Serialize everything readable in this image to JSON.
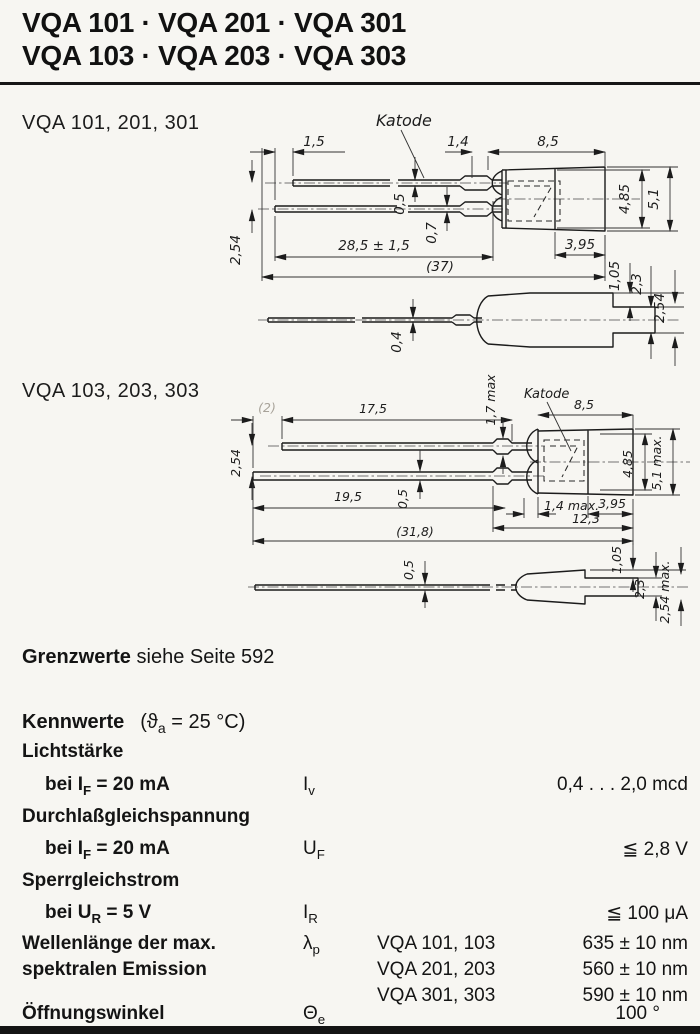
{
  "header": {
    "title_line1": "VQA 101 · VQA 201 · VQA 301",
    "title_line2": "VQA 103 · VQA 203 · VQA 303"
  },
  "sections": {
    "drawing1_label": "VQA 101, 201, 301",
    "drawing2_label": "VQA 103, 203, 303"
  },
  "drawing1": {
    "dims": {
      "lead_offset": "1,5",
      "katode": "Katode",
      "gap": "1,4",
      "body_len": "8,5",
      "lead_upper_th": "0,5",
      "lead_lower_th": "0,7",
      "lead_len": "28,5 ± 1,5",
      "overall": "(37)",
      "lead_pitch": "2,54",
      "body_inner_h": "4,85",
      "body_outer_h": "5,1",
      "body_back": "3,95",
      "side_lead_th": "0,4",
      "side_step": "1,05",
      "side_nose": "2,3",
      "side_nose_max": "2,54"
    }
  },
  "drawing2": {
    "dims": {
      "lead_offset": "(2)",
      "lead_upper_len": "17,5",
      "crimp_max": "1,7 max",
      "katode": "Katode",
      "body_len": "8,5",
      "lead_pitch": "2,54",
      "lead_lower_th": "0,5",
      "lead_lower_len": "19,5",
      "dome_max": "1,4 max.",
      "body_back": "3,95",
      "body_total": "12,3",
      "overall": "(31,8)",
      "body_inner_h": "4,85",
      "body_outer_h": "5,1 max.",
      "side_lead_th": "0,5",
      "side_step": "1,05",
      "side_nose": "2,3",
      "side_nose_max": "2,54 max."
    }
  },
  "grenzwerte": {
    "label_bold": "Grenzwerte",
    "label_rest": "siehe Seite 592"
  },
  "kennwerte": {
    "heading": "Kennwerte",
    "cond_pre": "(ϑ",
    "cond_sub": "a",
    "cond_post": " = 25 °C)"
  },
  "table": {
    "rows": [
      {
        "name": "Lichtstärke",
        "cond_pre": "bei I",
        "cond_sub": "F",
        "cond_post": " = 20 mA",
        "sym_main": "I",
        "sym_sub": "v",
        "value": "0,4 . . . 2,0 mcd"
      },
      {
        "name": "Durchlaßgleichspannung",
        "cond_pre": "bei I",
        "cond_sub": "F",
        "cond_post": " = 20 mA",
        "sym_main": "U",
        "sym_sub": "F",
        "value": "≦ 2,8 V"
      },
      {
        "name": "Sperrgleichstrom",
        "cond_pre": "bei U",
        "cond_sub": "R",
        "cond_post": " = 5 V",
        "sym_main": "I",
        "sym_sub": "R",
        "value": "≦ 100 μA"
      },
      {
        "name": "Wellenlänge der max.",
        "name2": "spektralen Emission",
        "sym_main": "λ",
        "sym_sub": "p",
        "variants": [
          {
            "types": "VQA 101, 103",
            "value": "635 ± 10 nm"
          },
          {
            "types": "VQA 201, 203",
            "value": "560 ± 10 nm"
          },
          {
            "types": "VQA 301, 303",
            "value": "590 ± 10 nm"
          }
        ]
      },
      {
        "name": "Öffnungswinkel",
        "sym_main": "Θ",
        "sym_sub": "e",
        "value": "100 °"
      }
    ]
  }
}
